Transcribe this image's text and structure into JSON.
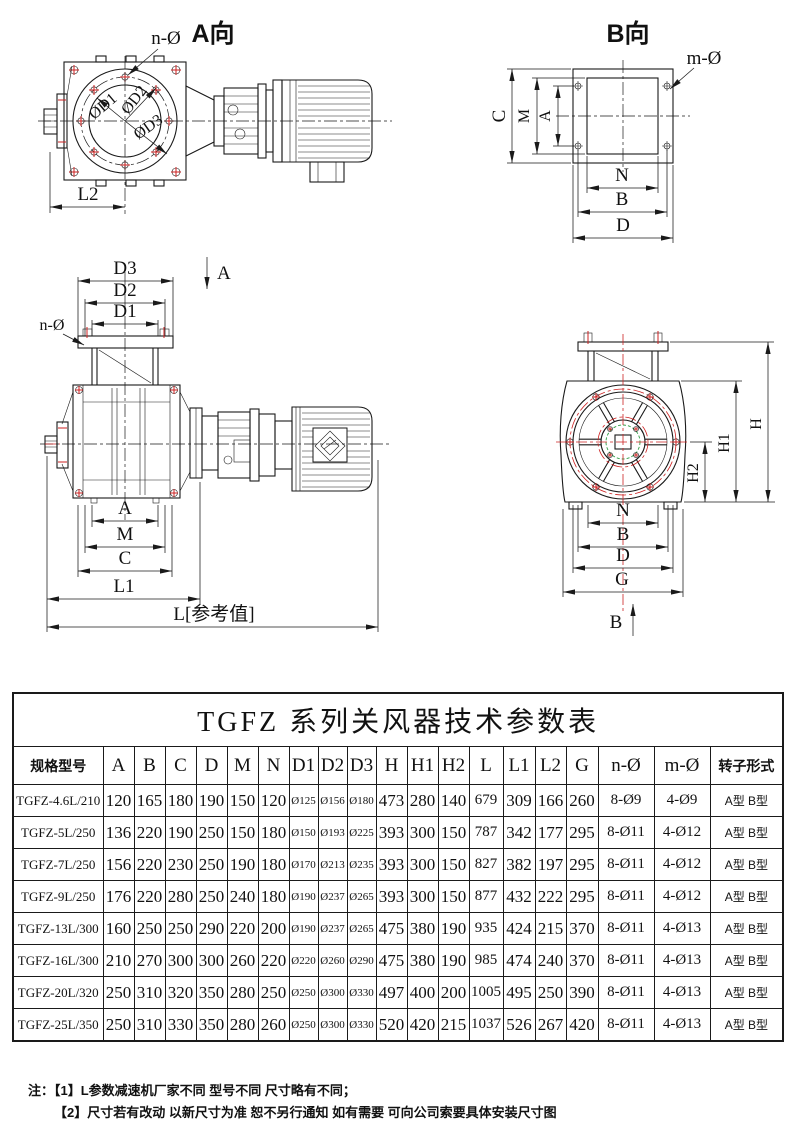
{
  "views": {
    "view_a": {
      "title": "A向",
      "n_hole_label": "n-Ø",
      "dia1": "ØD1",
      "dia2": "ØD2",
      "dia3": "ØD3",
      "l2": "L2"
    },
    "view_b": {
      "title": "B向",
      "m_hole_label": "m-Ø",
      "dim_c": "C",
      "dim_m": "M",
      "dim_a": "A",
      "dim_n": "N",
      "dim_b": "B",
      "dim_d": "D"
    },
    "front": {
      "dim_d3": "D3",
      "dim_d2": "D2",
      "dim_d1": "D1",
      "n_hole_label": "n-Ø",
      "section_mark": "A",
      "dim_a": "A",
      "dim_m": "M",
      "dim_c": "C",
      "dim_l1": "L1",
      "dim_l": "L[参考值]"
    },
    "side": {
      "dim_h": "H",
      "dim_h1": "H1",
      "dim_h2": "H2",
      "dim_n": "N",
      "dim_b": "B",
      "dim_d": "D",
      "dim_g": "G",
      "section_mark": "B"
    }
  },
  "table": {
    "title": "TGFZ 系列关风器技术参数表",
    "headers": [
      "规格型号",
      "A",
      "B",
      "C",
      "D",
      "M",
      "N",
      "D1",
      "D2",
      "D3",
      "H",
      "H1",
      "H2",
      "L",
      "L1",
      "L2",
      "G",
      "n-Ø",
      "m-Ø",
      "转子形式"
    ],
    "rows": [
      [
        "TGFZ-4.6L/210",
        "120",
        "165",
        "180",
        "190",
        "150",
        "120",
        "Ø125",
        "Ø156",
        "Ø180",
        "473",
        "280",
        "140",
        "679",
        "309",
        "166",
        "260",
        "8-Ø9",
        "4-Ø9",
        "A型 B型"
      ],
      [
        "TGFZ-5L/250",
        "136",
        "220",
        "190",
        "250",
        "150",
        "180",
        "Ø150",
        "Ø193",
        "Ø225",
        "393",
        "300",
        "150",
        "787",
        "342",
        "177",
        "295",
        "8-Ø11",
        "4-Ø12",
        "A型 B型"
      ],
      [
        "TGFZ-7L/250",
        "156",
        "220",
        "230",
        "250",
        "190",
        "180",
        "Ø170",
        "Ø213",
        "Ø235",
        "393",
        "300",
        "150",
        "827",
        "382",
        "197",
        "295",
        "8-Ø11",
        "4-Ø12",
        "A型 B型"
      ],
      [
        "TGFZ-9L/250",
        "176",
        "220",
        "280",
        "250",
        "240",
        "180",
        "Ø190",
        "Ø237",
        "Ø265",
        "393",
        "300",
        "150",
        "877",
        "432",
        "222",
        "295",
        "8-Ø11",
        "4-Ø12",
        "A型 B型"
      ],
      [
        "TGFZ-13L/300",
        "160",
        "250",
        "250",
        "290",
        "220",
        "200",
        "Ø190",
        "Ø237",
        "Ø265",
        "475",
        "380",
        "190",
        "935",
        "424",
        "215",
        "370",
        "8-Ø11",
        "4-Ø13",
        "A型 B型"
      ],
      [
        "TGFZ-16L/300",
        "210",
        "270",
        "300",
        "300",
        "260",
        "220",
        "Ø220",
        "Ø260",
        "Ø290",
        "475",
        "380",
        "190",
        "985",
        "474",
        "240",
        "370",
        "8-Ø11",
        "4-Ø13",
        "A型 B型"
      ],
      [
        "TGFZ-20L/320",
        "250",
        "310",
        "320",
        "350",
        "280",
        "250",
        "Ø250",
        "Ø300",
        "Ø330",
        "497",
        "400",
        "200",
        "1005",
        "495",
        "250",
        "390",
        "8-Ø11",
        "4-Ø13",
        "A型 B型"
      ],
      [
        "TGFZ-25L/350",
        "250",
        "310",
        "330",
        "350",
        "280",
        "260",
        "Ø250",
        "Ø300",
        "Ø330",
        "520",
        "420",
        "215",
        "1037",
        "526",
        "267",
        "420",
        "8-Ø11",
        "4-Ø13",
        "A型 B型"
      ]
    ]
  },
  "notes": {
    "label": "注：",
    "line1": "【1】L参数减速机厂家不同 型号不同 尺寸略有不同；",
    "line2": "【2】尺寸若有改动 以新尺寸为准 恕不另行通知 如有需要 可向公司索要具体安装尺寸图"
  }
}
